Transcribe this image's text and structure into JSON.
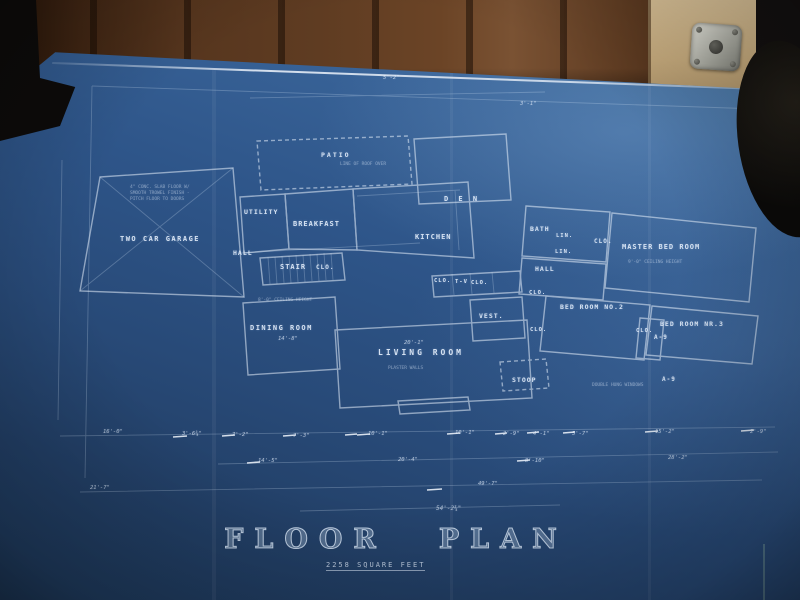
{
  "scene": {
    "description": "photograph of an architectural blueprint lying on a table against wood paneling",
    "colors": {
      "wood_dark": "#3f2513",
      "wood_light": "#7a5233",
      "tan_panel": "#c3a87b",
      "metal_bracket": "#a8a9a0",
      "shadow_objects": "#0d0b0a"
    }
  },
  "blueprint": {
    "title_left": "FLOOR",
    "title_right": "PLAN",
    "subtitle": "2258 SQUARE FEET",
    "ink_color": "#e4eefb",
    "paper_top_color": "#49779f",
    "paper_bottom_color": "#1d3859"
  },
  "rooms": [
    {
      "label": "TWO CAR GARAGE",
      "x": 120,
      "y": 236,
      "fs": 7,
      "ls": 1.5
    },
    {
      "label": "PATIO",
      "x": 321,
      "y": 152,
      "fs": 6.5,
      "ls": 2
    },
    {
      "label": "UTILITY",
      "x": 244,
      "y": 209,
      "fs": 6.5
    },
    {
      "label": "BREAKFAST",
      "x": 293,
      "y": 221,
      "fs": 7
    },
    {
      "label": "KITCHEN",
      "x": 415,
      "y": 234,
      "fs": 7
    },
    {
      "label": "D E N",
      "x": 444,
      "y": 196,
      "fs": 7,
      "ls": 3
    },
    {
      "label": "HALL",
      "x": 233,
      "y": 250,
      "fs": 6.5
    },
    {
      "label": "STAIR",
      "x": 280,
      "y": 264,
      "fs": 7
    },
    {
      "label": "CLO.",
      "x": 316,
      "y": 265,
      "fs": 6
    },
    {
      "label": "BATH",
      "x": 530,
      "y": 226,
      "fs": 6.5
    },
    {
      "label": "LIN.",
      "x": 556,
      "y": 234,
      "fs": 5.5
    },
    {
      "label": "CLO.",
      "x": 594,
      "y": 239,
      "fs": 6
    },
    {
      "label": "LIN.",
      "x": 555,
      "y": 250,
      "fs": 5.5
    },
    {
      "label": "HALL",
      "x": 535,
      "y": 266,
      "fs": 6.5
    },
    {
      "label": "MASTER BED ROOM",
      "x": 622,
      "y": 244,
      "fs": 7,
      "ls": 1
    },
    {
      "label": "CLO.",
      "x": 434,
      "y": 279,
      "fs": 5.5
    },
    {
      "label": "T-V",
      "x": 455,
      "y": 280,
      "fs": 5.5
    },
    {
      "label": "CLO.",
      "x": 471,
      "y": 281,
      "fs": 5.5
    },
    {
      "label": "CLO.",
      "x": 529,
      "y": 291,
      "fs": 5.5
    },
    {
      "label": "VEST.",
      "x": 479,
      "y": 313,
      "fs": 6.5
    },
    {
      "label": "CLO.",
      "x": 530,
      "y": 328,
      "fs": 5.5
    },
    {
      "label": "DINING ROOM",
      "x": 250,
      "y": 325,
      "fs": 7,
      "ls": 1.5
    },
    {
      "label": "LIVING ROOM",
      "x": 378,
      "y": 349,
      "fs": 8,
      "ls": 3
    },
    {
      "label": "BED ROOM NO.2",
      "x": 560,
      "y": 304,
      "fs": 6.5
    },
    {
      "label": "CLO.",
      "x": 636,
      "y": 329,
      "fs": 5.5
    },
    {
      "label": "BED ROOM NR.3",
      "x": 660,
      "y": 321,
      "fs": 6.5
    },
    {
      "label": "STOOP",
      "x": 512,
      "y": 377,
      "fs": 6.5
    },
    {
      "label": "A-9",
      "x": 654,
      "y": 335,
      "fs": 6
    },
    {
      "label": "A-9",
      "x": 662,
      "y": 377,
      "fs": 6
    }
  ],
  "dimensions": [
    {
      "label": "5'-2\"",
      "x": 383,
      "y": 76,
      "fs": 5.5
    },
    {
      "label": "3'-1\"",
      "x": 520,
      "y": 102,
      "fs": 5.5
    },
    {
      "label": "14'-8\"",
      "x": 278,
      "y": 337,
      "fs": 5.5
    },
    {
      "label": "20'-1\"",
      "x": 404,
      "y": 341,
      "fs": 5.5
    },
    {
      "label": "16'-0\"",
      "x": 103,
      "y": 430,
      "fs": 5.5
    },
    {
      "label": "3'-6¾\"",
      "x": 182,
      "y": 432,
      "fs": 5.5
    },
    {
      "label": "7'-2\"",
      "x": 232,
      "y": 433,
      "fs": 5.5
    },
    {
      "label": "7'-3\"",
      "x": 293,
      "y": 434,
      "fs": 5.5
    },
    {
      "label": "10'-1\"",
      "x": 368,
      "y": 432,
      "fs": 5.5
    },
    {
      "label": "10'-1\"",
      "x": 455,
      "y": 431,
      "fs": 5.5
    },
    {
      "label": "2'-9\"",
      "x": 503,
      "y": 432,
      "fs": 5.5
    },
    {
      "label": "4'-1\"",
      "x": 533,
      "y": 432,
      "fs": 5.5
    },
    {
      "label": "5'-7\"",
      "x": 572,
      "y": 432,
      "fs": 5.5
    },
    {
      "label": "15'-2\"",
      "x": 655,
      "y": 430,
      "fs": 5.5
    },
    {
      "label": "2'-9\"",
      "x": 750,
      "y": 430,
      "fs": 5.5
    },
    {
      "label": "14'-5\"",
      "x": 258,
      "y": 459,
      "fs": 5.5
    },
    {
      "label": "20'-4\"",
      "x": 398,
      "y": 458,
      "fs": 5.5
    },
    {
      "label": "8'-10\"",
      "x": 525,
      "y": 459,
      "fs": 5.5
    },
    {
      "label": "28'-2\"",
      "x": 668,
      "y": 456,
      "fs": 5.5
    },
    {
      "label": "21'-7\"",
      "x": 90,
      "y": 486,
      "fs": 5.5
    },
    {
      "label": "49'-7\"",
      "x": 478,
      "y": 482,
      "fs": 5.5
    },
    {
      "label": "54'-2¾\"",
      "x": 436,
      "y": 506,
      "fs": 6
    }
  ],
  "notes": [
    {
      "text": "4\" CONC. SLAB FLOOR W/",
      "x": 130,
      "y": 186,
      "fs": 4.5
    },
    {
      "text": "SMOOTH TROWEL FINISH -",
      "x": 130,
      "y": 192,
      "fs": 4.5
    },
    {
      "text": "PITCH FLOOR TO DOORS",
      "x": 130,
      "y": 198,
      "fs": 4.5
    },
    {
      "text": "LINE OF ROOF OVER",
      "x": 340,
      "y": 163,
      "fs": 4.5
    },
    {
      "text": "8'-0\" CEILING HEIGHT",
      "x": 258,
      "y": 299,
      "fs": 4.5
    },
    {
      "text": "PLASTER WALLS",
      "x": 388,
      "y": 367,
      "fs": 4.5
    },
    {
      "text": "9'-0\" CEILING HEIGHT",
      "x": 628,
      "y": 261,
      "fs": 4.5
    },
    {
      "text": "DOUBLE HUNG WINDOWS",
      "x": 592,
      "y": 384,
      "fs": 4.5
    }
  ]
}
